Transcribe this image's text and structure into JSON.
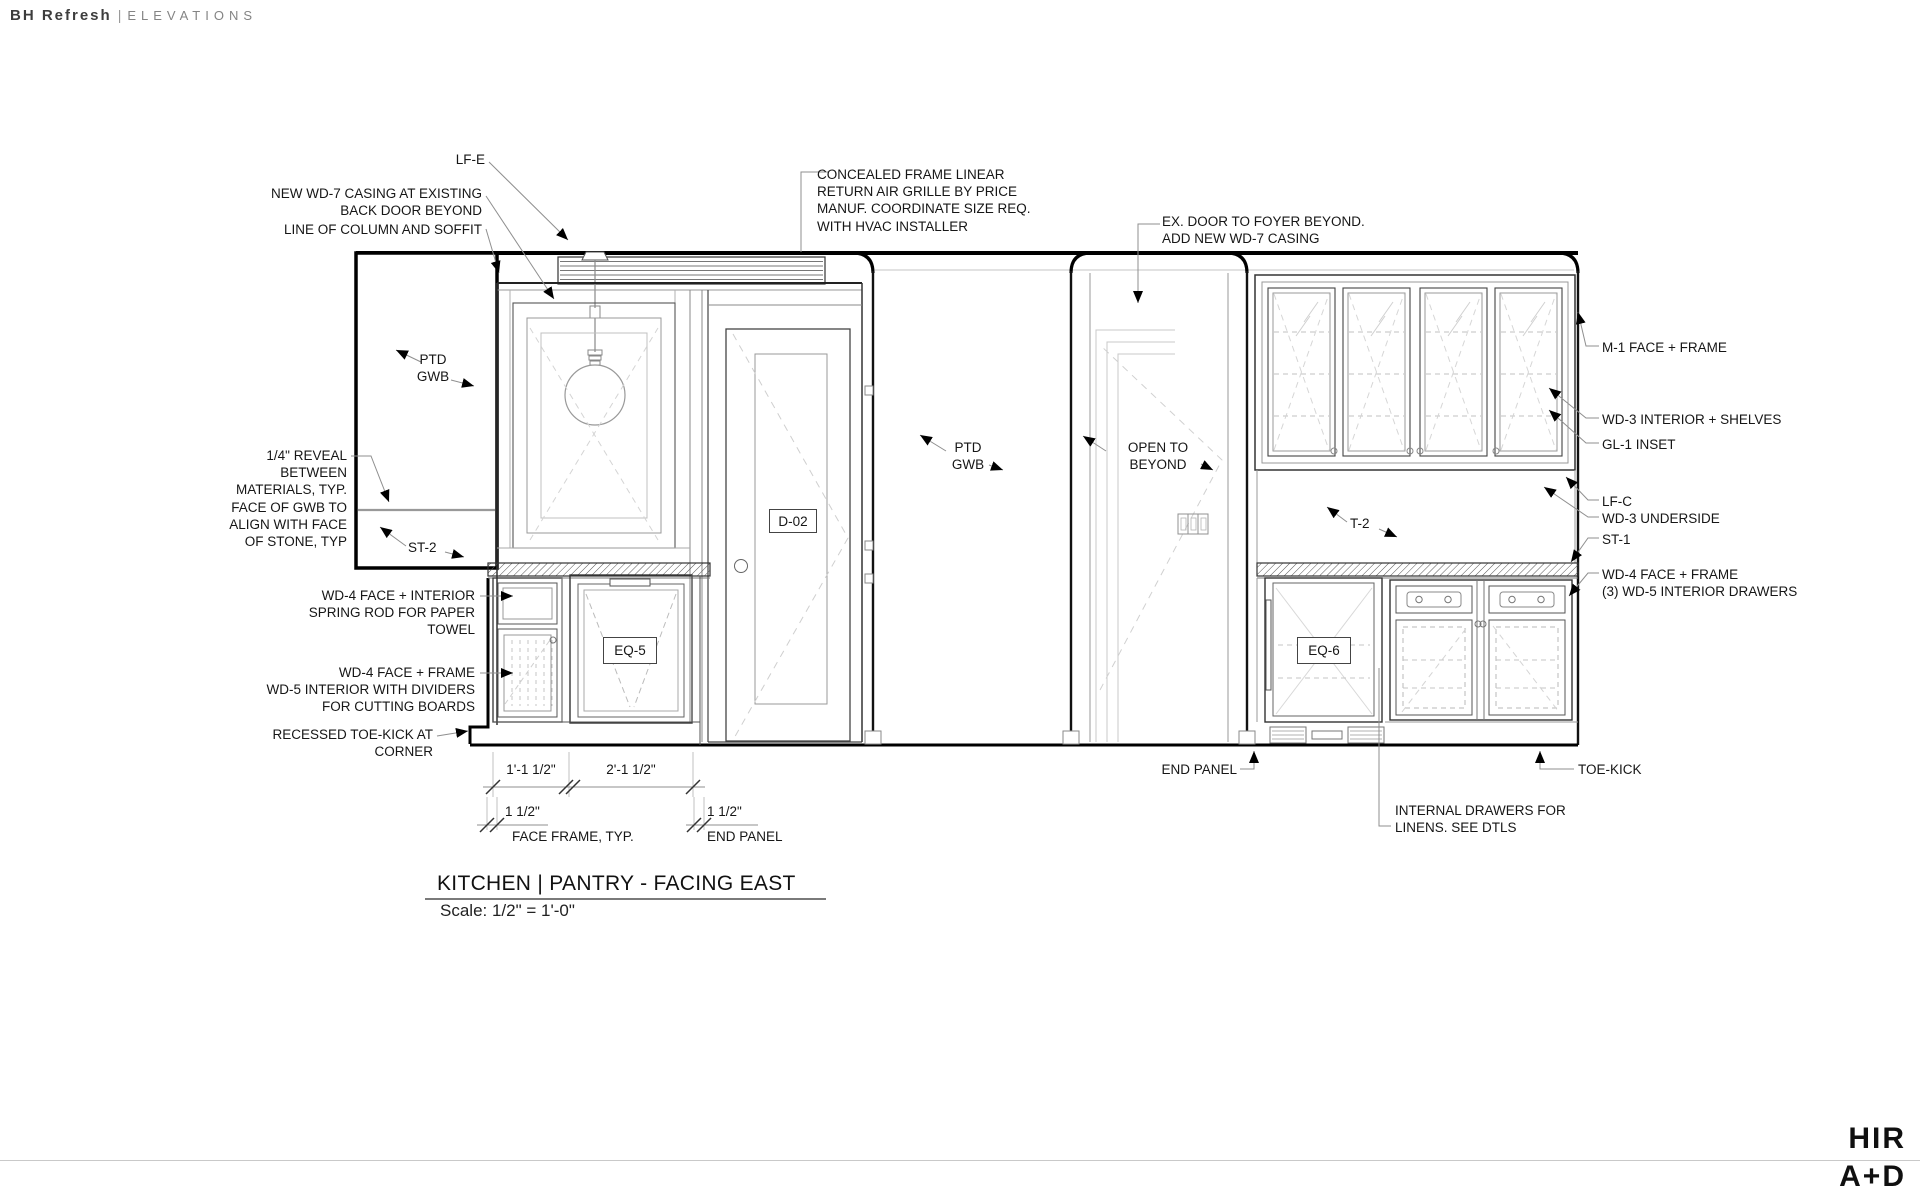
{
  "header": {
    "project": "BH Refresh",
    "separator": "|",
    "section": "ELEVATIONS"
  },
  "title_block": {
    "title": "KITCHEN | PANTRY - FACING EAST",
    "scale": "Scale: 1/2\" = 1'-0\""
  },
  "logo": {
    "line1": "HIR",
    "line2": "A+D"
  },
  "style": {
    "ink": "#1a1a1a",
    "leader": "#8f8f8f"
  },
  "ann": {
    "lf_e": "LF-E",
    "wd7_casing": "NEW WD-7 CASING AT EXISTING\nBACK DOOR BEYOND",
    "column_soffit": "LINE OF COLUMN AND SOFFIT",
    "ptd_gwb_left": "PTD\nGWB",
    "reveal": "1/4\" REVEAL\nBETWEEN\nMATERIALS, TYP.\nFACE OF GWB TO\nALIGN WITH FACE\nOF STONE, TYP",
    "st2": "ST-2",
    "paper_towel": "WD-4 FACE + INTERIOR\nSPRING ROD FOR PAPER\nTOWEL",
    "cutting_boards": "WD-4 FACE + FRAME\nWD-5 INTERIOR WITH DIVIDERS\nFOR CUTTING BOARDS",
    "recessed_toekick": "RECESSED TOE-KICK AT\nCORNER",
    "air_grille": "CONCEALED FRAME LINEAR\nRETURN AIR GRILLE BY PRICE\nMANUF. COORDINATE SIZE REQ.\nWITH HVAC INSTALLER",
    "ex_door": "EX. DOOR TO FOYER BEYOND.\nADD NEW WD-7 CASING",
    "ptd_gwb_center": "PTD\nGWB",
    "open_beyond": "OPEN TO\nBEYOND",
    "t2": "T-2",
    "m1": "M-1 FACE + FRAME",
    "wd3_shelves": "WD-3 INTERIOR + SHELVES",
    "gl1": "GL-1 INSET",
    "lfc": "LF-C",
    "wd3_underside": "WD-3 UNDERSIDE",
    "st1": "ST-1",
    "wd4_drawers": "WD-4 FACE + FRAME\n(3) WD-5 INTERIOR DRAWERS",
    "toe_kick": "TOE-KICK",
    "internal_drawers": "INTERNAL DRAWERS FOR\nLINENS. SEE DTLS",
    "end_panel_right": "END PANEL",
    "end_panel_left": "END PANEL",
    "face_frame": "FACE FRAME, TYP.",
    "d02": "D-02",
    "eq5": "EQ-5",
    "eq6": "EQ-6"
  },
  "dims": {
    "d1": "1'-1 1/2\"",
    "d2": "2'-1 1/2\"",
    "d3": "1 1/2\"",
    "d4": "1 1/2\""
  }
}
